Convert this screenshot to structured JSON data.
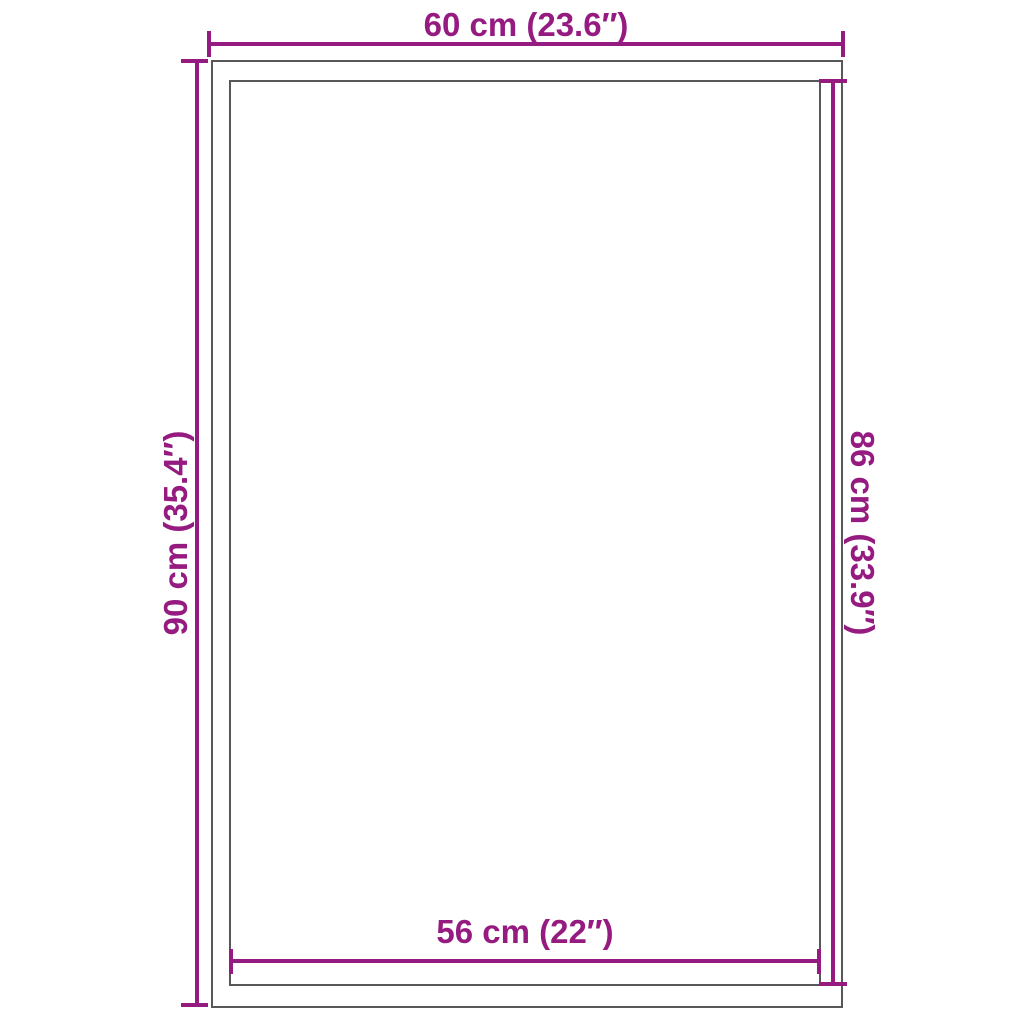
{
  "colors": {
    "accent": "#951b81",
    "outline": "#58585a",
    "background": "#ffffff"
  },
  "diagram": {
    "type": "product-dimension-diagram",
    "shape": "rectangle-with-inner-border",
    "dimensions": {
      "top": {
        "label": "60 cm (23.6″)",
        "measures": "outer-width"
      },
      "left": {
        "label": "90 cm (35.4″)",
        "measures": "outer-height"
      },
      "right": {
        "label": "86 cm (33.9″)",
        "measures": "inner-height"
      },
      "bottom": {
        "label": "56 cm (22″)",
        "measures": "inner-width"
      }
    }
  }
}
